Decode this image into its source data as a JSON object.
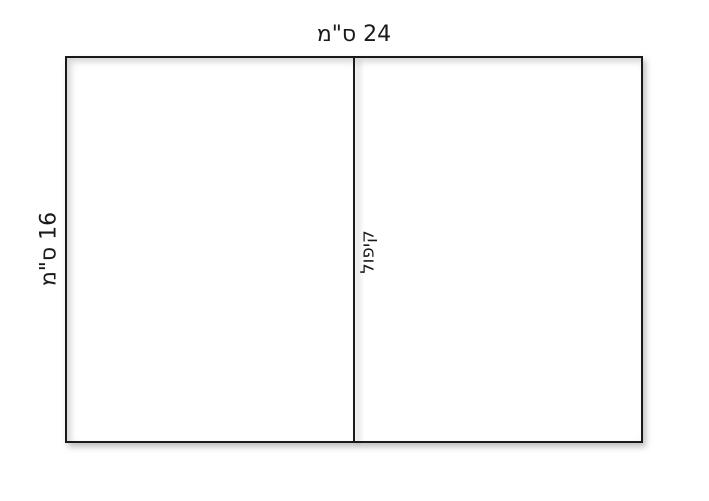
{
  "diagram": {
    "labels": {
      "top": "24 ס\"מ",
      "left": "16 ס\"מ",
      "fold": "קיפול"
    },
    "colors": {
      "background": "#ffffff",
      "line": "#1a1a1a",
      "text": "#1a1a1a"
    }
  }
}
